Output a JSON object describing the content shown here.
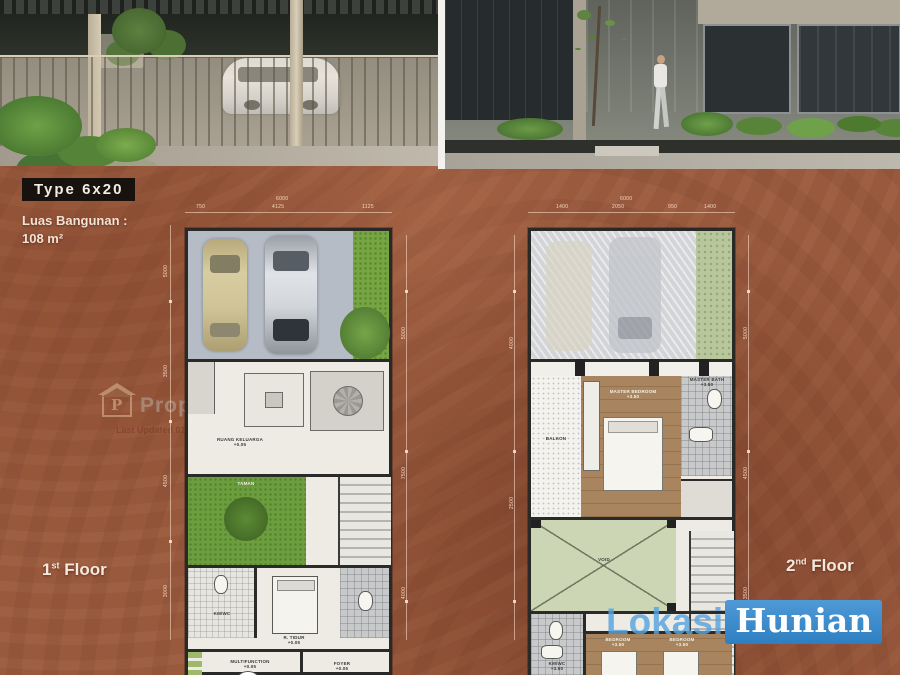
{
  "colors": {
    "background_brown": "#99593d",
    "logo_blue": "#3a8ed2",
    "garden_green": "#6d9e3e",
    "sage_green": "#ccd6b4"
  },
  "header": {
    "type_label": "Type 6x20",
    "area_title": "Luas Bangunan :",
    "area_value": "108 m²"
  },
  "floor_labels": {
    "first_num": "1",
    "first_sup": "st",
    "first_word": "Floor",
    "second_num": "2",
    "second_sup": "nd",
    "second_word": "Floor"
  },
  "watermark": {
    "brand": "Property",
    "icon_letter": "P",
    "updated": "Last Updated 01/01/2023"
  },
  "logo": {
    "lokasi": "Lokasi",
    "hunian": "Hunian"
  },
  "plan1": {
    "dims": {
      "total": "6000",
      "top": [
        "750",
        "4125",
        "1125"
      ],
      "left": [
        "5000",
        "3500",
        "4500",
        "3000"
      ],
      "right": [
        "5000",
        "7500",
        "4000"
      ]
    },
    "rooms": {
      "living": {
        "name": "RUANG KELUARGA",
        "elev": "+0.05"
      },
      "garden": {
        "name": "TAMAN"
      },
      "bath": {
        "name": "KM/WC"
      },
      "bed": {
        "name": "R. TIDUR",
        "elev": "+0.05"
      },
      "multi": {
        "name": "MULTIFUNCTION",
        "elev": "+0.05"
      },
      "foyer": {
        "name": "FOYER",
        "elev": "+0.05"
      }
    }
  },
  "plan2": {
    "dims": {
      "total": "6000",
      "top": [
        "1400",
        "2050",
        "950",
        "1400"
      ],
      "left": [
        "4000",
        "2500"
      ],
      "right": [
        "5000",
        "4500",
        "3500"
      ]
    },
    "rooms": {
      "balcony": {
        "name": "BALKON"
      },
      "master": {
        "name": "MASTER BEDROOM",
        "elev": "+3.50"
      },
      "masterbath": {
        "name": "MASTER BATH",
        "elev": "+3.50"
      },
      "void": {
        "name": "VOID"
      },
      "bath": {
        "name": "KM/WC",
        "elev": "+3.50"
      },
      "bed1": {
        "name": "BEDROOM",
        "elev": "+3.50"
      },
      "bed2": {
        "name": "BEDROOM",
        "elev": "+3.50"
      }
    }
  }
}
